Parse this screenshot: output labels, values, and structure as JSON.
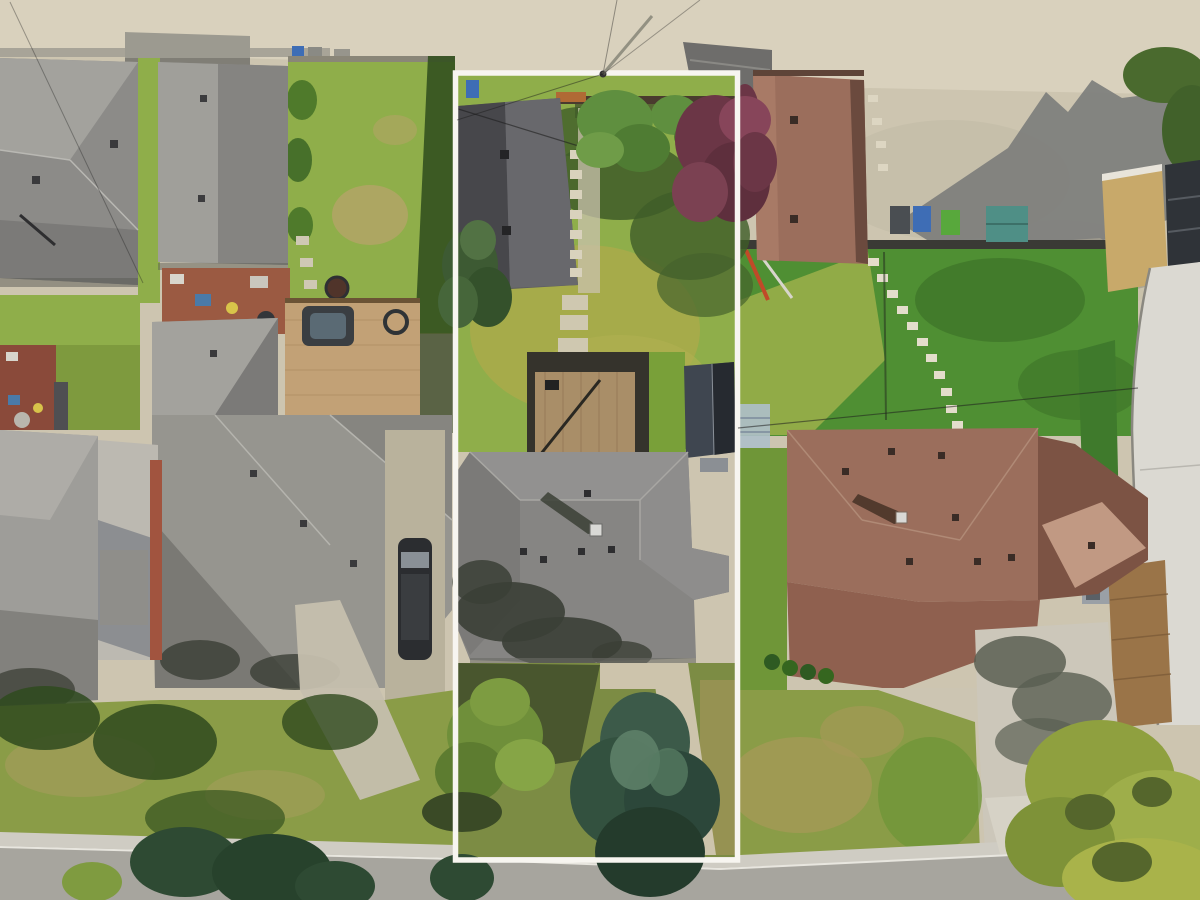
{
  "scene": {
    "type": "aerial-drone-photograph",
    "description": "Top-down aerial drone photo of a suburban residential block. A white rectangular boundary line highlights one deep narrow lot containing a detached garage at the back lane, a large green backyard lawn, a wood deck with a dark shed, a gray hip-roof bungalow, and large evergreen trees in the front yard. Neighboring lots have gray and brown shingled roofs, lawns, decks, a gravel lane at top and a street at bottom.",
    "highlighted_property": {
      "outline_color": "#f7f5f0",
      "outline_shape": "rectangle",
      "contents": [
        "detached-garage",
        "back-lawn",
        "paver-walkway",
        "wood-deck",
        "dark-shed",
        "main-house-gray-hip-roof",
        "front-spruce-trees",
        "front-walkway"
      ]
    },
    "landmarks": [
      "back-lane-top",
      "gravel-yard-top-right",
      "street-bottom",
      "gray-roof-houses-left",
      "brown-roof-houses-right",
      "van-on-driveway",
      "hot-tub-deck",
      "garbage-bins",
      "teal-shed",
      "stepping-stone-path"
    ]
  },
  "palette": {
    "gravel": "#cdc5b0",
    "roadTop": "#d9d1bd",
    "roadBottom": "#a7a59e",
    "sidewalk": "#cfccc3",
    "concrete": "#ccc5b2",
    "concretePad": "#bcb9b1",
    "driveway": "#ccc7ba",
    "shadowGravel": "#7d7e7c",
    "shadowConcrete": "#6e7370",
    "grass": "#8fae4a",
    "grassSunlit": "#a8ab4a",
    "grassRich": "#4f8f33",
    "grassDark": "#33511f",
    "grassDry": "#b3a466",
    "grassFront": "#7c8c44",
    "grassFrontLeft": "#8a9c47",
    "roofGray": "#8c8b88",
    "roofGrayLight": "#a3a29d",
    "roofGrayDark": "#7b7a78",
    "roofCharcoalL": "#47474b",
    "roofCharcoalR": "#68686c",
    "roofHouse": "#868583",
    "roofBrown": "#9b6e5c",
    "roofBrownDark": "#7c5344",
    "roofBrownMid": "#8f604f",
    "roofBrownLit": "#c9a18b",
    "treeGreen": "#5f8f3f",
    "treeGreenDark": "#3c5a26",
    "spruce": "#3c5a49",
    "spruceDark": "#243b2c",
    "spruceLight": "#5d7f68",
    "treePurple": "#6b3646",
    "treePurpleLight": "#87455a",
    "treeYellowGreen": "#8fa03f",
    "deckWood": "#c2a176",
    "deckWoodDark": "#9a7448",
    "patioRed": "#9b5a42",
    "fenceDark": "#3a3a35",
    "binBlue": "#3e6db5",
    "binGreen": "#58a83c",
    "shedTeal": "#4f8f86",
    "shedDark": "#3f4650",
    "vanDark": "#2b2d30",
    "plywood": "#c8a96a",
    "buildingWhite": "#dbd9d2",
    "redWall": "#a1543f",
    "outlineWhite": "#f7f5f0",
    "shadowBlob": "#3b3f36",
    "chimneyWhite": "#d9d9d6"
  }
}
